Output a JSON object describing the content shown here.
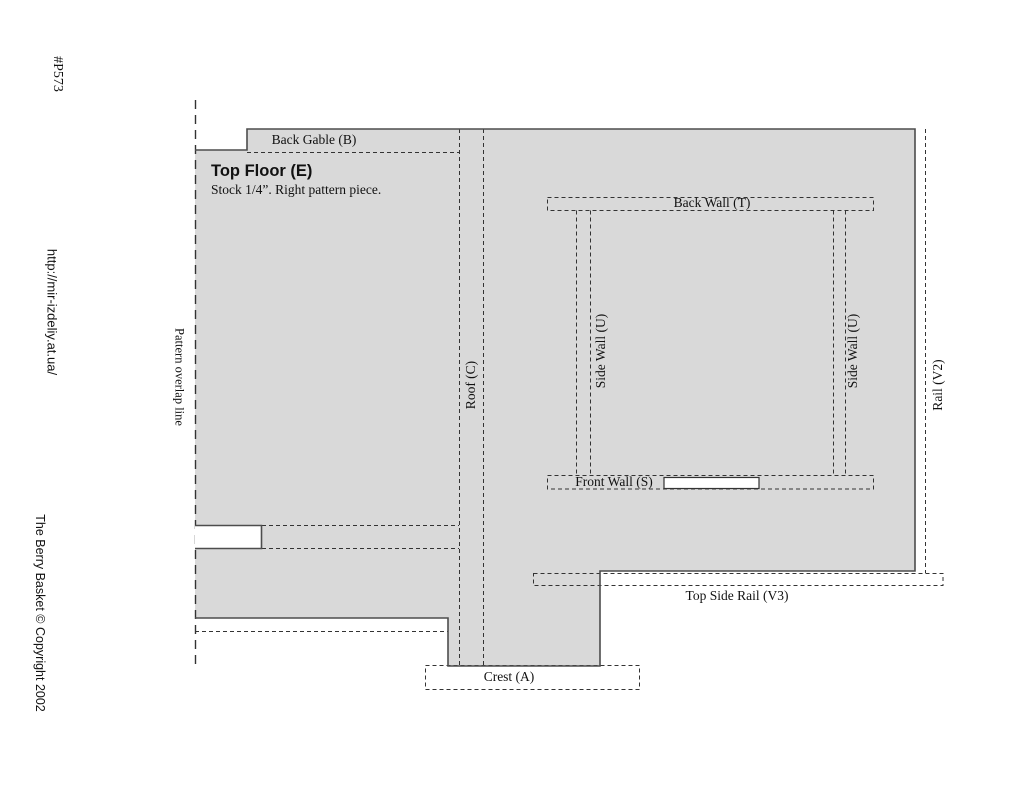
{
  "margin": {
    "part_number": "#P573",
    "url": "http://mir-izdeliy.at.ua/",
    "copyright": "The Berry Basket © Copyright 2002"
  },
  "diagram": {
    "overlap_line_label": "Pattern overlap line",
    "title": "Top Floor (E)",
    "subtitle": "Stock 1/4”. Right pattern piece.",
    "pieces": {
      "back_gable": "Back Gable (B)",
      "roof": "Roof (C)",
      "back_wall": "Back Wall (T)",
      "side_wall_left": "Side Wall (U)",
      "side_wall_right": "Side Wall (U)",
      "front_wall": "Front Wall (S)",
      "rail": "Rail (V2)",
      "top_side_rail": "Top Side Rail (V3)",
      "crest": "Crest (A)"
    },
    "colors": {
      "piece_fill": "#d9d9d9",
      "outline": "#4d4d4d",
      "dashed_line": "#333333",
      "background": "#ffffff"
    }
  }
}
